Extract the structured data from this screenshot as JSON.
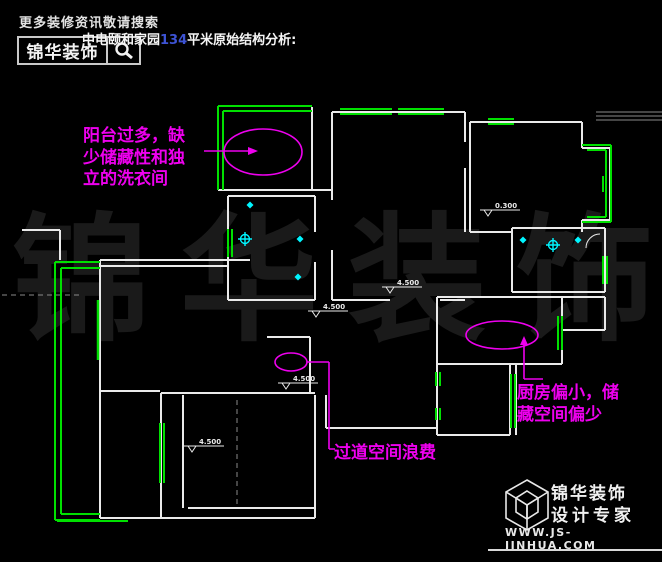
{
  "header": {
    "search_hint": "更多装修资讯敬请搜索",
    "brand": "锦华装饰",
    "title": {
      "prefix": "中电颐和家园",
      "number": "134",
      "suffix": "平米原始结构分析:"
    },
    "title_number_color": "#3d53d4"
  },
  "watermark": {
    "chars": [
      "锦",
      "华",
      "装",
      "饰"
    ],
    "color": "#1a1a1a"
  },
  "annotations": {
    "balcony_note": {
      "lines": [
        "阳台过多，缺",
        "少储藏性和独",
        "立的洗衣间"
      ]
    },
    "kitchen_note": {
      "lines": [
        "厨房偏小，储",
        "藏空间偏少"
      ]
    },
    "corridor_note": {
      "lines": [
        "过道空间浪费"
      ]
    },
    "color": "#ee00ee"
  },
  "plan": {
    "colors": {
      "wall": "#eaeaea",
      "window": "#00e000",
      "symbol": "#00f5ff",
      "note": "#ee00ee",
      "dash": "#8a8a8a"
    },
    "elevation_markers": [
      {
        "label": "4.500",
        "x": 382,
        "y": 287
      },
      {
        "label": "4.500",
        "x": 308,
        "y": 311
      },
      {
        "label": "0.300",
        "x": 480,
        "y": 210
      },
      {
        "label": "4.500",
        "x": 278,
        "y": 383
      },
      {
        "label": "4.500",
        "x": 184,
        "y": 446
      }
    ],
    "symbols": [
      {
        "type": "sprinkler",
        "x": 245,
        "y": 239
      },
      {
        "type": "sprinkler",
        "x": 553,
        "y": 245
      },
      {
        "type": "dot",
        "x": 250,
        "y": 205
      },
      {
        "type": "dot",
        "x": 300,
        "y": 239
      },
      {
        "type": "dot",
        "x": 298,
        "y": 277
      },
      {
        "type": "dot",
        "x": 523,
        "y": 240
      },
      {
        "type": "dot",
        "x": 578,
        "y": 240
      }
    ]
  },
  "footer": {
    "brand": "锦华装饰",
    "tagline": "设计专家",
    "url": "WWW.JS-JINHUA.COM"
  }
}
